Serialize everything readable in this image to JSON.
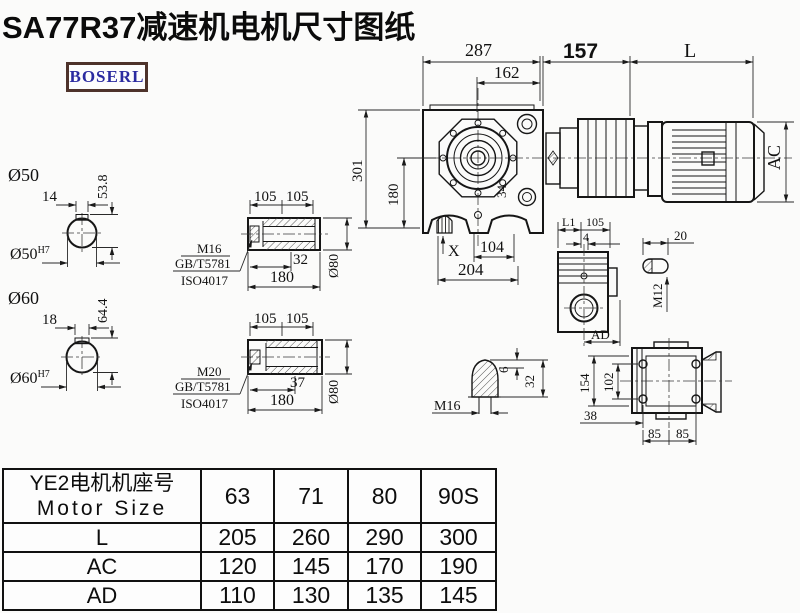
{
  "title": "SA77R37减速机电机尺寸图纸",
  "logo_text": "BOSERL",
  "main_view": {
    "dim_287": "287",
    "dim_162": "162",
    "dim_157": "157",
    "dim_L": "L",
    "dim_AC": "AC",
    "dim_301": "301",
    "dim_180": "180",
    "dim_34": "34",
    "dim_X": "X",
    "dim_104": "104",
    "dim_204": "204"
  },
  "shaft_50": {
    "label": "Ø50",
    "key_width": "14",
    "key_height": "53.8",
    "bore_label": "Ø50",
    "bore_tol": "H7"
  },
  "shaft_60": {
    "label": "Ø60",
    "key_width": "18",
    "key_height": "64.4",
    "bore_label": "Ø60",
    "bore_tol": "H7"
  },
  "hollow_shaft_1": {
    "dim_105_a": "105",
    "dim_105_b": "105",
    "dim_32": "32",
    "dim_180": "180",
    "dim_dia": "Ø80",
    "bolt": "M16",
    "std_1": "GB/T5781",
    "std_2": "ISO4017"
  },
  "hollow_shaft_2": {
    "dim_105_a": "105",
    "dim_105_b": "105",
    "dim_37": "37",
    "dim_180": "180",
    "dim_dia": "Ø80",
    "bolt": "M20",
    "std_1": "GB/T5781",
    "std_2": "ISO4017"
  },
  "side_view": {
    "dim_L1": "L1",
    "dim_105": "105",
    "dim_4": "4",
    "dim_AD": "AD"
  },
  "key_detail": {
    "dim_20": "20",
    "thread": "M12"
  },
  "vent_detail": {
    "dim_6": "6",
    "dim_32": "32",
    "thread": "M16"
  },
  "bottom_view": {
    "dim_154": "154",
    "dim_102": "102",
    "dim_38": "38",
    "dim_85_a": "85",
    "dim_85_b": "85"
  },
  "table": {
    "header_cn": "YE2电机机座号",
    "header_en": "Motor Size",
    "columns": [
      "63",
      "71",
      "80",
      "90S"
    ],
    "rows": [
      {
        "label": "L",
        "values": [
          "205",
          "260",
          "290",
          "300"
        ]
      },
      {
        "label": "AC",
        "values": [
          "120",
          "145",
          "170",
          "190"
        ]
      },
      {
        "label": "AD",
        "values": [
          "110",
          "130",
          "135",
          "145"
        ]
      }
    ]
  }
}
